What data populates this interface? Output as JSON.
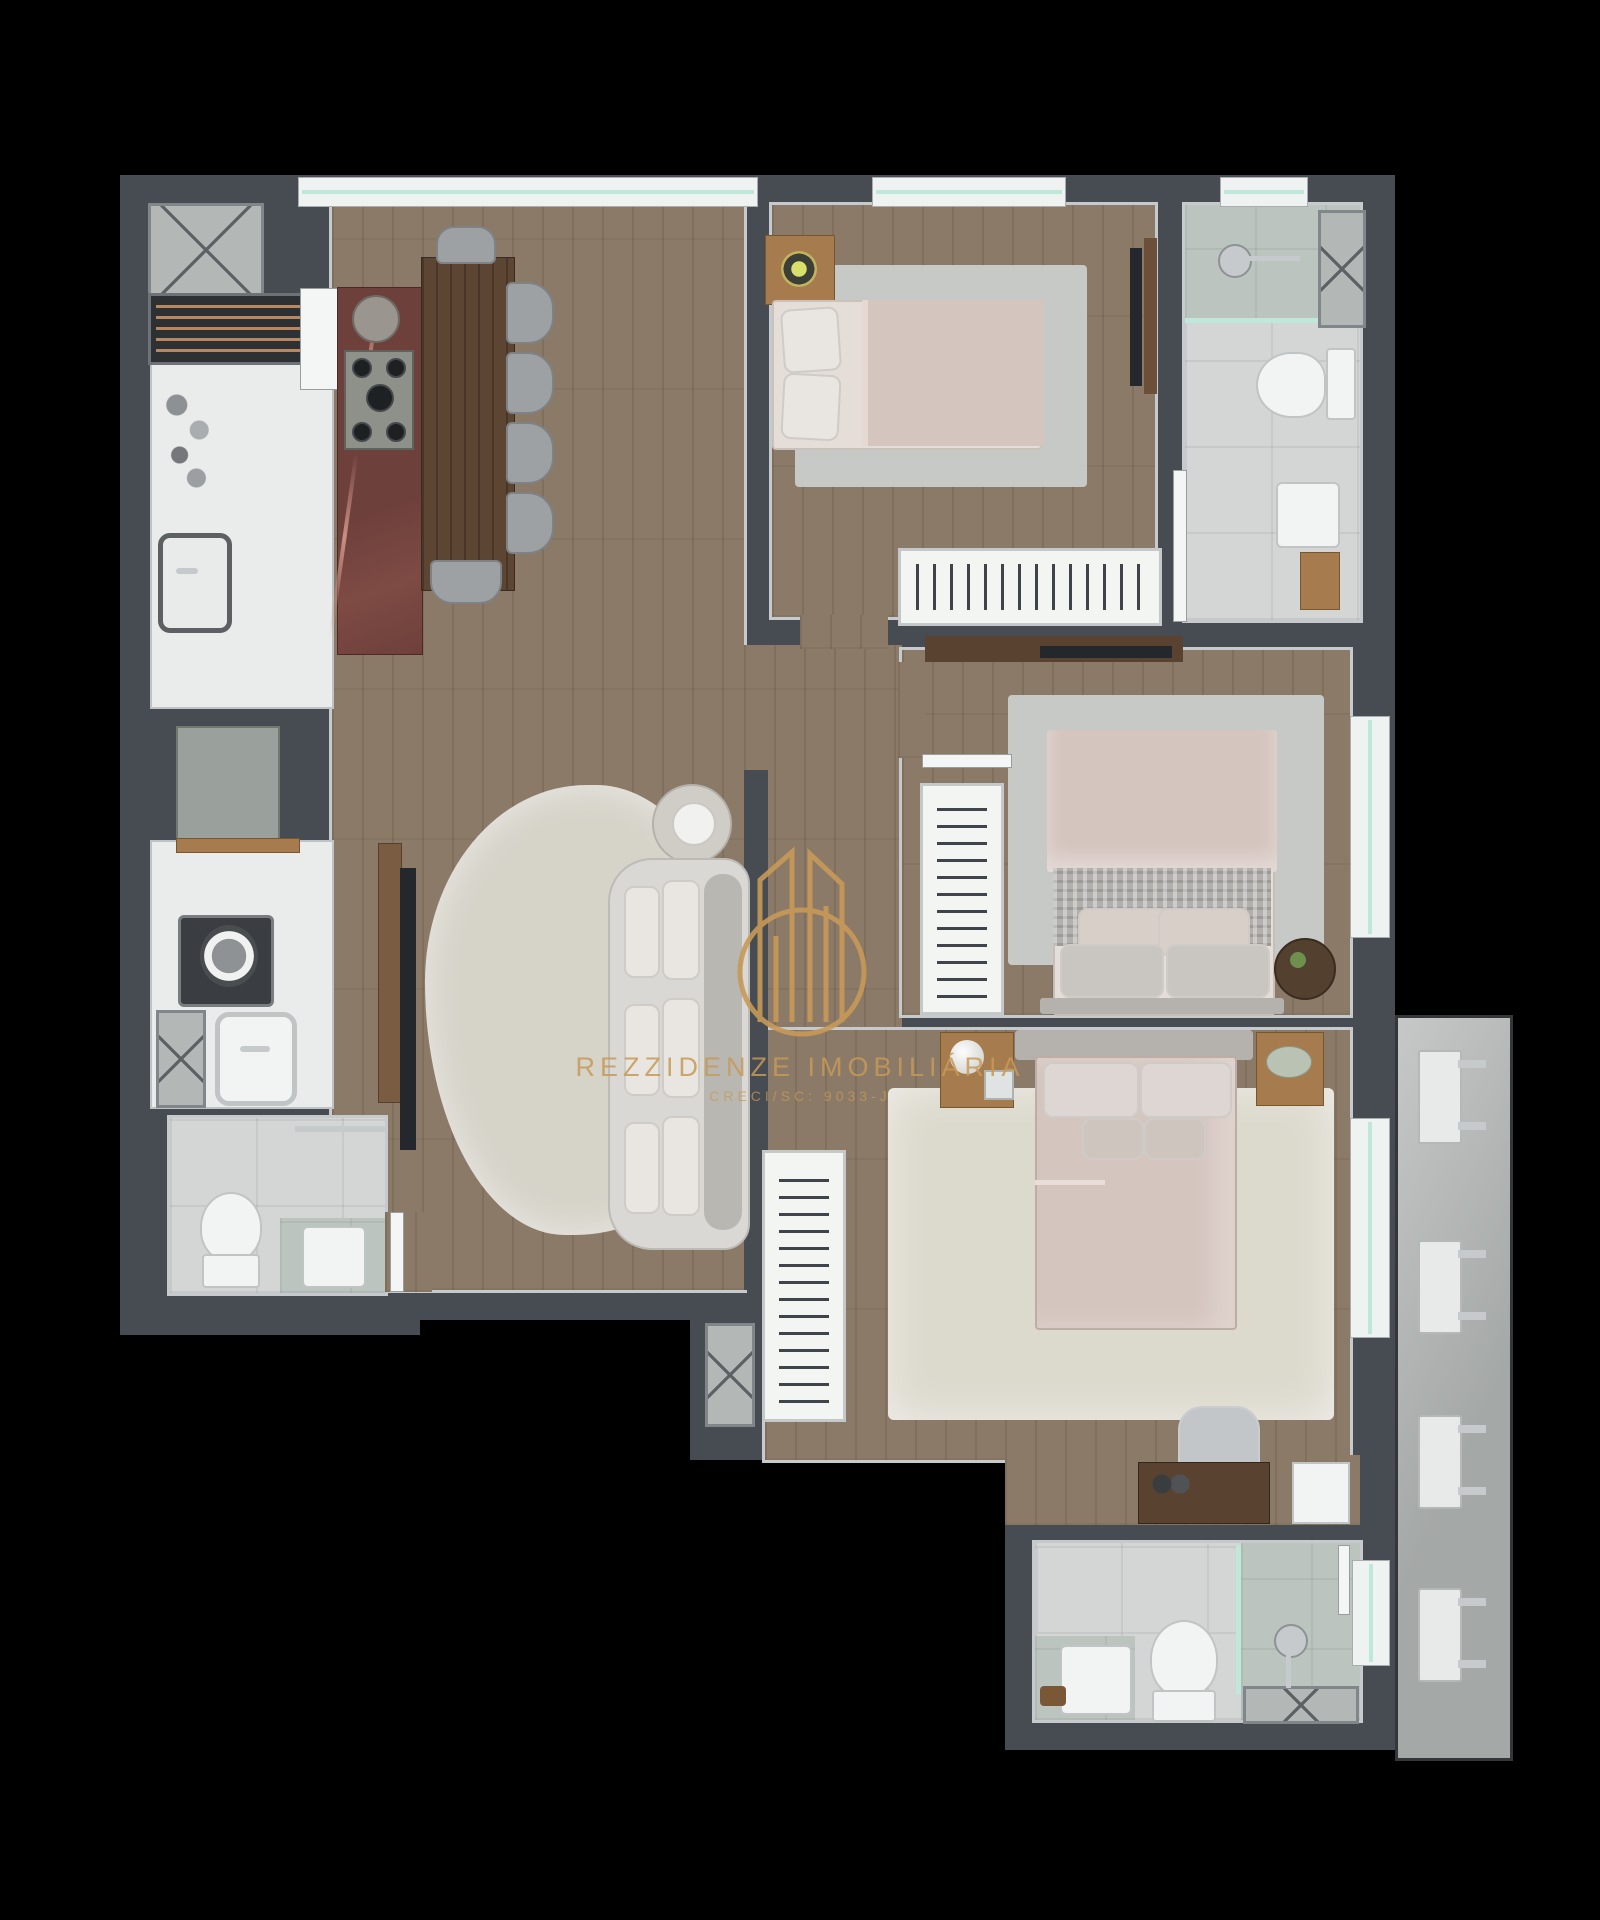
{
  "canvas": {
    "width": 1600,
    "height": 1920
  },
  "watermark": {
    "line1": "REZZIDENZE IMOBILIÁRIA",
    "line2": "CRECI/SC: 9033-J"
  },
  "balcony": {
    "ac_unit_count": 4
  },
  "palette": {
    "bg": "#000000",
    "wall": "#474b52",
    "wood": "#8b7a67",
    "tile": "#d3d6d4",
    "tile_dark": "#bcc4c0",
    "counter": "#e9ecea",
    "cabinet_grey": "#9aa09b",
    "marble": "#6e403c",
    "marble_vein": "#c98f83",
    "table_wood": "#5d4534",
    "chair_grey": "#9da1a3",
    "rug_grey": "#c7c9c7",
    "rug_cream": "#dcd9cd",
    "rug_living": "#d6d3c9",
    "sofa": "#dad8d4",
    "sofa_shadow": "#b9b7b2",
    "bed_sheet": "#d5c5bf",
    "bed_mattress": "#e4ddd8",
    "pillow": "#e9e6e2",
    "headboard": "#b5b1ad",
    "blanket_grey": "#b2b0ad",
    "nightstand_wood": "#a67c4e",
    "dark_wood": "#59422f",
    "tv_black": "#24272b",
    "glass_teal": "#bfe7da",
    "window_sill": "#eef2f1",
    "chrome": "#c6cacd",
    "white_fixture": "#f2f4f3",
    "shaft_fill": "#b3b7b6",
    "concrete": "#b2b6b4",
    "ac_white": "#e8eae9",
    "gold": "#c79a57",
    "lamp_glow": "#d8e06c"
  }
}
